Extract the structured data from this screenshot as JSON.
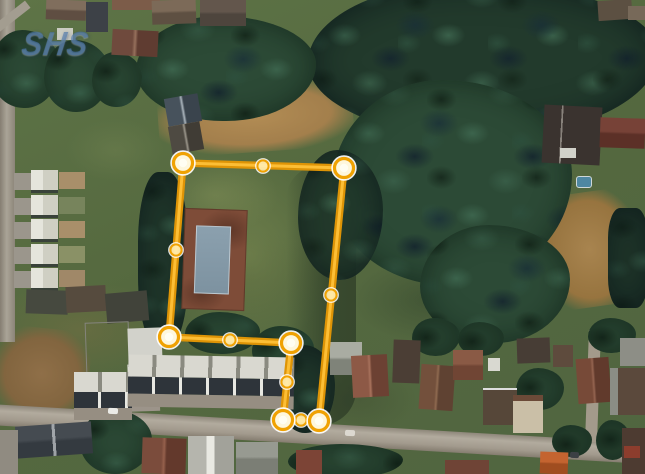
{
  "watermark": {
    "text": "SHS"
  },
  "map": {
    "type": "satellite-imagery",
    "overlay": {
      "shape": "parcel-boundary-polygon",
      "closed": true,
      "colors": {
        "line": "#DE9406",
        "line_highlight": "#FFC23B",
        "vertex_fill": "#FEF7DC",
        "vertex_ring": "#F0A202",
        "vertex_outer_ring": "rgba(255,255,255,0.92)",
        "midpoint_fill": "#FFEDB0",
        "midpoint_ring": "#F0A202"
      },
      "vertices": [
        {
          "x": 183,
          "y": 163
        },
        {
          "x": 344,
          "y": 168
        },
        {
          "x": 319,
          "y": 421
        },
        {
          "x": 283,
          "y": 420
        },
        {
          "x": 291,
          "y": 343
        },
        {
          "x": 169,
          "y": 337
        }
      ],
      "midpoints": [
        {
          "x": 263,
          "y": 166
        },
        {
          "x": 331,
          "y": 295
        },
        {
          "x": 301,
          "y": 420
        },
        {
          "x": 287,
          "y": 382
        },
        {
          "x": 230,
          "y": 340
        },
        {
          "x": 176,
          "y": 250
        }
      ]
    }
  }
}
